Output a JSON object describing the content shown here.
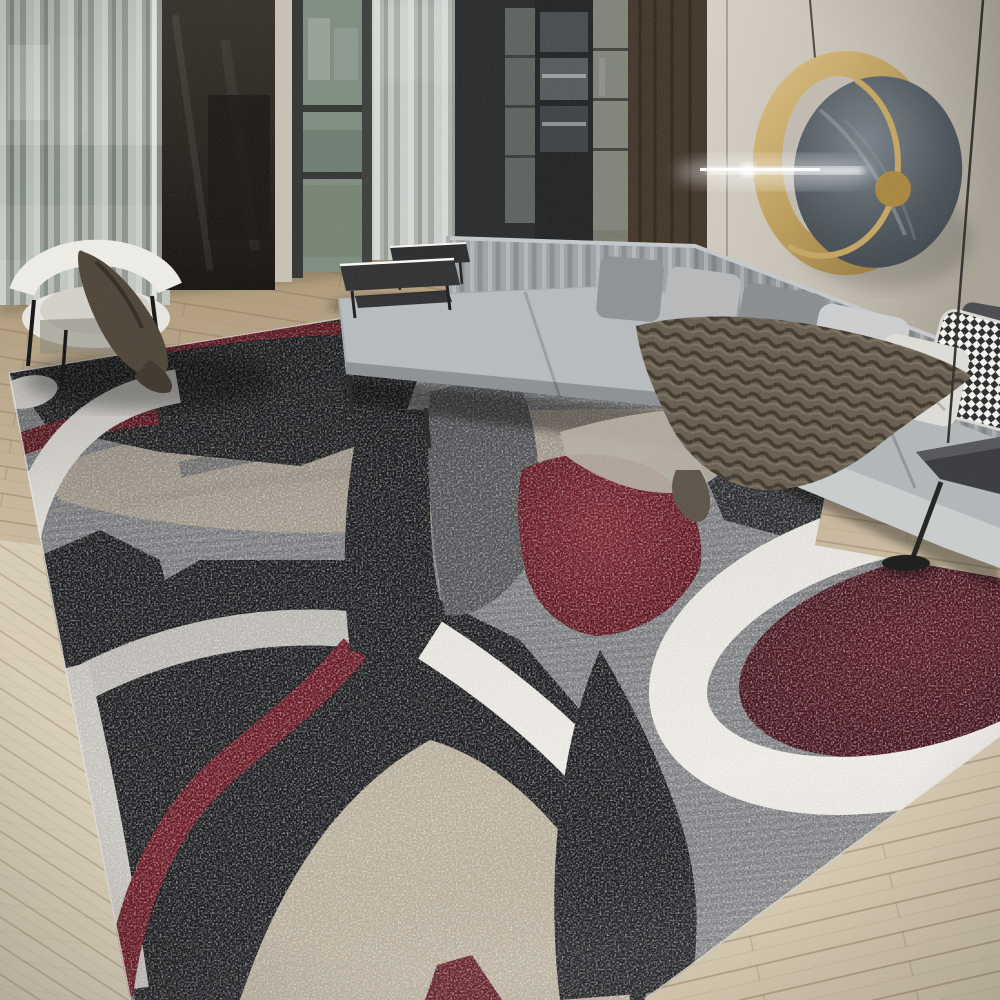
{
  "scene": {
    "description": "Product photo of a modern abstract area rug with overlapping red, black, gray and white circle pattern, shown in a living room with a gray L-shaped sectional sofa, taupe fur throw, gold circular wall mirror with linear wall light, sheer floor-to-ceiling curtains, dark cabinetry, a white barrel chair with dark drape, two low black tables, a black floor lamp and light wood plank flooring."
  },
  "palette": {
    "wall_light": "#d3cdc1",
    "wall_dark": "#aaa498",
    "wood_column": "#44382b",
    "cabinet_dark": "#2a2c2e",
    "cabinet_glass": "#6b726d",
    "curtain_base": "#aab0ab",
    "window_glass": "#90998f",
    "dark_panel": "#27231e",
    "door_frame": "#343734",
    "door_jamb": "#c6c0b4",
    "floor_top": "#a99474",
    "floor_mid": "#c6b69b",
    "floor_light": "#d9cfb9",
    "rug_black": "#191a1d",
    "rug_dark": "#515356",
    "rug_mid": "#7b7d80",
    "rug_silver": "#c7c4bf",
    "rug_white": "#ebe8e3",
    "rug_taupe": "#a79d8f",
    "rug_taupe_light": "#b6ac99",
    "rug_red": "#6e1722",
    "rug_red_deep": "#4e1019",
    "rug_maroon": "#41101a",
    "sofa_base": "#a6aaad",
    "sofa_light": "#bdc1c3",
    "sofa_mid": "#93979a",
    "sofa_skirt": "#c9cccd",
    "pillow_silver": "#cbcdcf",
    "pillow_cream": "#dddbd5",
    "pillow_charcoal": "#4a4b4e",
    "pillow_dark": "#717477",
    "throw_taupe": "#685e50",
    "chair_white": "#edebe5",
    "chair_drape": "#4f463a",
    "lamp_black": "#262625",
    "mirror_gold": "#b89a58",
    "mirror_slate": "#4d555c",
    "beam_white": "#ffffff"
  }
}
